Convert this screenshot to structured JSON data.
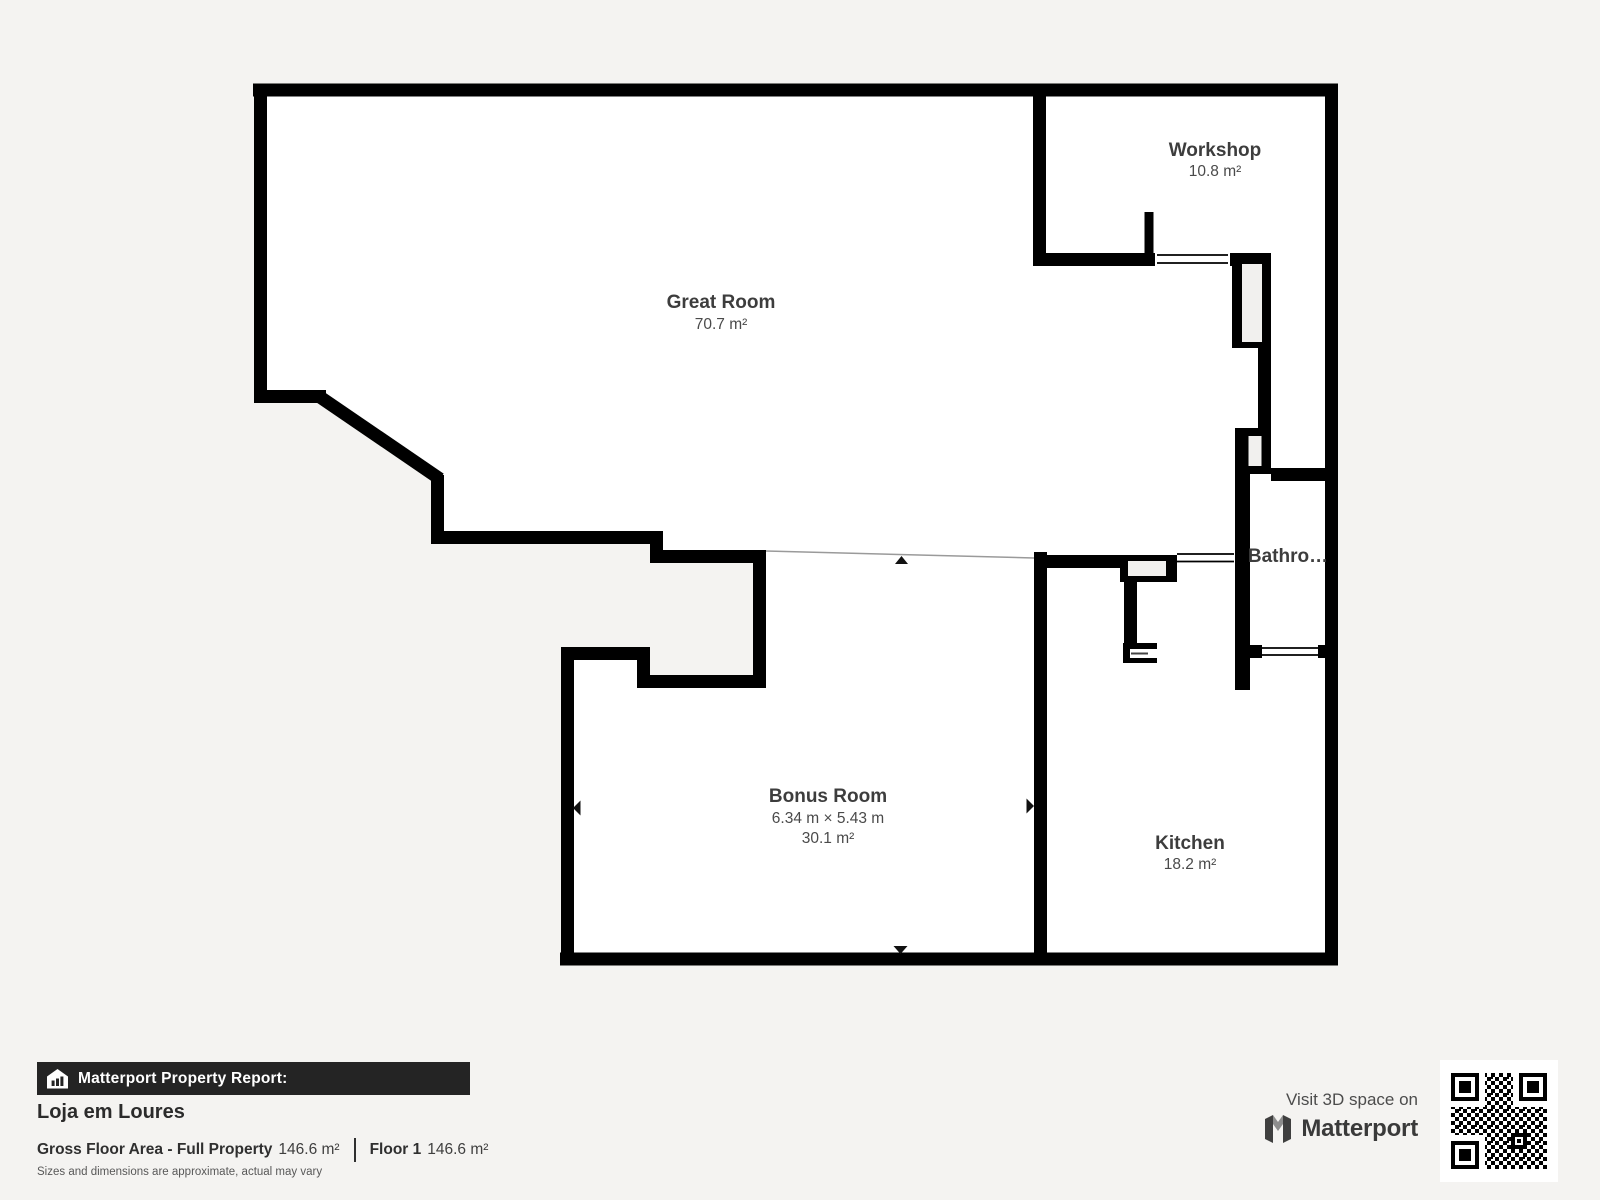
{
  "plan": {
    "rooms": [
      {
        "id": "great-room",
        "name": "Great Room",
        "area": "70.7 m²"
      },
      {
        "id": "workshop",
        "name": "Workshop",
        "area": "10.8 m²"
      },
      {
        "id": "bathroom",
        "name": "Bathro…"
      },
      {
        "id": "bonus-room",
        "name": "Bonus Room",
        "dimensions": "6.34 m × 5.43 m",
        "area": "30.1 m²"
      },
      {
        "id": "kitchen",
        "name": "Kitchen",
        "area": "18.2 m²"
      }
    ],
    "icons": {
      "dimension_arrows": [
        "up-arrow-icon",
        "down-arrow-icon",
        "left-arrow-icon",
        "right-arrow-icon"
      ]
    }
  },
  "report": {
    "banner_title": "Matterport Property Report:",
    "banner_icon": "house-chart-icon",
    "property_name": "Loja em Loures",
    "gross_label": "Gross Floor Area - Full Property",
    "gross_value": "146.6 m²",
    "floor_label": "Floor 1",
    "floor_value": "146.6 m²",
    "disclaimer": "Sizes and dimensions are approximate, actual may vary"
  },
  "promo": {
    "visit_text": "Visit 3D space on",
    "brand": "Matterport",
    "brand_icon": "matterport-logo",
    "qr_icon": "qr-code"
  },
  "colors": {
    "background": "#f4f3f1",
    "floor": "#ffffff",
    "walls": "#000000",
    "duct_fill": "#f1f0ee",
    "banner_bg": "#242424",
    "label_text": "#3d3d3d"
  }
}
